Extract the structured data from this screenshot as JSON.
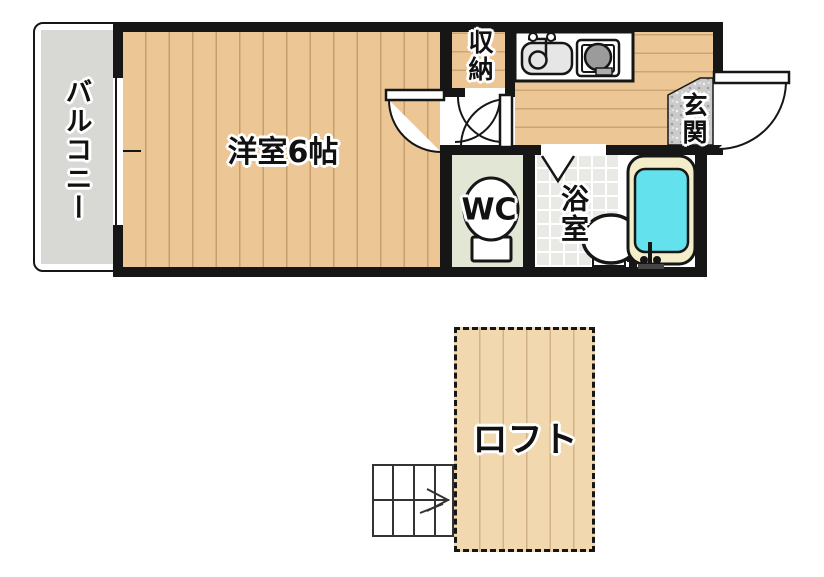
{
  "title": "apartment-floor-plan",
  "colors": {
    "wall": "#161616",
    "wood": "#ecc795",
    "loft_wood": "#f1d8ae",
    "balcony_floor": "#d8d8d4",
    "wc_floor": "#e2e6d4",
    "bath_tile": "#e9e9e6",
    "granite": "#c9c9c9",
    "tub_rim": "#f3edca",
    "tub_water": "#63e1ec",
    "burner_gray": "#9b9b9b"
  },
  "rooms": {
    "balcony": {
      "label": "バルコニー"
    },
    "western_room": {
      "label": "洋室6帖"
    },
    "storage": {
      "label": "収納"
    },
    "entrance": {
      "label": "玄関"
    },
    "wc": {
      "label": "WC"
    },
    "bathroom": {
      "label": "浴室"
    },
    "loft": {
      "label": "ロフト"
    }
  },
  "icons": {
    "kitchen_sink": "kitchen-sink-icon",
    "stove": "stove-burner-icon",
    "toilet": "toilet-icon",
    "washbasin": "washbasin-icon",
    "bathtub": "bathtub-icon",
    "stairs": "staircase-arrow-icon",
    "doors": "door-swing-arc-icon",
    "window": "window-icon"
  }
}
